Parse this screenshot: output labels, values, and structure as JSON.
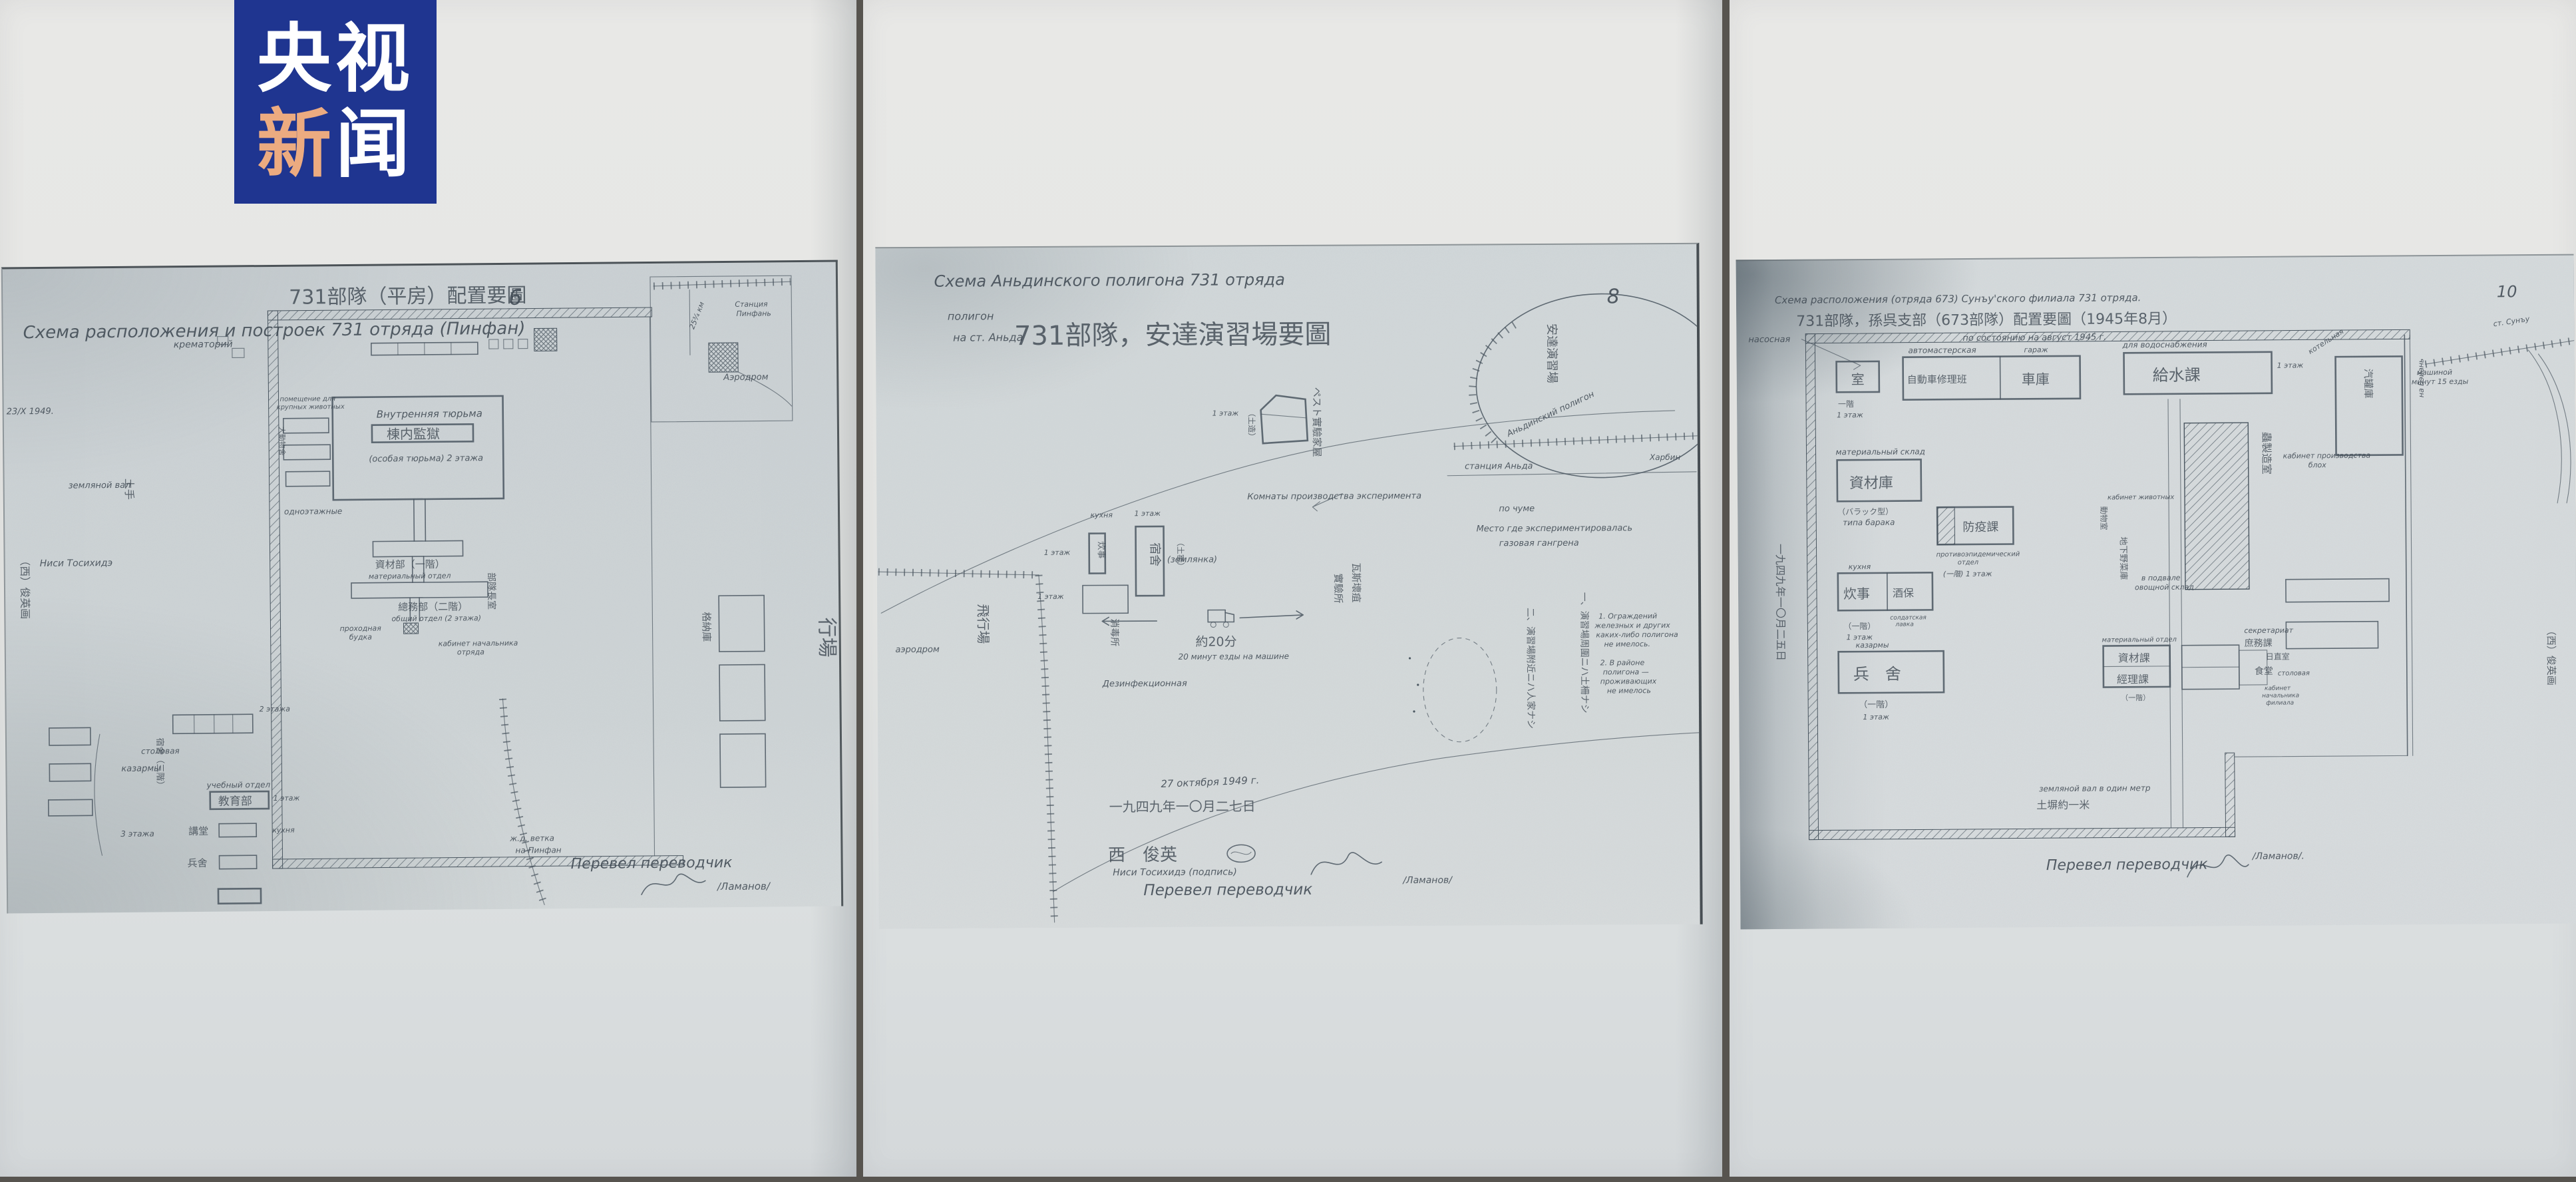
{
  "colors": {
    "logo_bg": "#1f3590",
    "logo_accent": "#ecab80",
    "logo_white": "#ffffff",
    "ink": "#3d4751",
    "paper": "#e6e7e5",
    "copy": "#ccd2d4"
  },
  "logo": {
    "line1": "央视",
    "line2a": "新",
    "line2b": "闻"
  },
  "sheets": [
    {
      "title_cjk": "731部隊（平房）配置要圖",
      "title_ru": "Схема расположения и построек 731 отряда (Пинфан)",
      "page": "6",
      "date_note": "23/X 1949.",
      "west_sig": "（西）俊英画",
      "nisi": "Ниси Тосихидэ",
      "earth_wall_ru": "земляной вал",
      "earth_wall_cjk": "土手",
      "crematorium": "крематорий",
      "station1": "Станция",
      "station2": "Пинфань",
      "km_note": "25¾ км",
      "animals1": "помещение для",
      "animals2": "крупных животных",
      "animals_cjk": "大動物舍",
      "one_story": "одноэтажные",
      "prison_ru": "Внутренняя тюрьма",
      "prison_cjk": "棟内監獄",
      "prison_note": "(особая тюрьма)",
      "prison_floors": "2 этажа",
      "material_cjk": "資材部（一階）",
      "material_ru": "материальный отдел",
      "general_cjk": "總務部（二階）",
      "general_ru": "общий отдел (2 этажа)",
      "gate1": "проходная",
      "gate2": "будка",
      "chief1": "кабинет начальника",
      "chief2": "отряда",
      "chief_cjk": "部隊長室",
      "aero": "Аэродром",
      "hangar_cjk": "格納庫",
      "field_cjk": "行場",
      "dorm_cjk": "宿舍（三階）",
      "barracks": "казармы",
      "dining": "столовая",
      "floors3": "3 этажа",
      "floors2": "2 этажа",
      "edu_ru": "учебный отдел",
      "edu_cjk": "教育部",
      "edu_floor": "1 этаж",
      "kitchen": "кухня",
      "hall_cjk": "講堂",
      "barr2_cjk": "兵舍",
      "rail1": "ж.д. ветка",
      "rail2": "на Пинфан",
      "translator": "Перевел переводчик",
      "lamanov": "/Ламанов/"
    },
    {
      "title_ru": "Схема Аньдинского полигона 731 отряда",
      "sub1": "полигон",
      "sub2": "на ст. Аньда",
      "title_cjk": "731部隊，安達演習場要圖",
      "page": "8",
      "range_cjk": "安達演習場",
      "range_ru": "Аньдинский полигон",
      "station": "станция Аньда",
      "harbin": "Харбин",
      "rooms1": "Комнаты производства эксперимента",
      "rooms2": "по чуме",
      "house_cjk": "ペスト實驗家屋",
      "house_floor": "1 этаж",
      "house_mud": "（土造）",
      "aero": "аэродром",
      "field_cjk": "飛行場",
      "kitchen_ru": "кухня",
      "kitchen_cjk": "炊事",
      "kitchen_floor": "1 этаж",
      "dorm_cjk": "宿舍",
      "dugout_cjk": "（土窑）",
      "dugout_ru": "(землянка)",
      "dorm_floor": "1 этаж",
      "bld_floor": "1 этаж",
      "disinf_cjk": "消毒所",
      "disinf_ru": "Дезинфекционная",
      "drive_cjk": "約20分",
      "drive_ru": "20 минут езды на машине",
      "gas1": "Место где экспериментировалась",
      "gas2": "газовая гангрена",
      "gas_cjk1": "瓦斯壞疽",
      "gas_cjk2": "實驗所",
      "note1_cjk": "一、演習場周圍ニハ土柵ナシ",
      "note2_cjk": "二、演習場附近ニハ人家ナシ",
      "n1a": "1. Ограждений",
      "n1b": "железных и других",
      "n1c": "каких-либо полигона",
      "n1d": "не имелось.",
      "n2a": "2. В районе",
      "n2b": "полигона —",
      "n2c": "проживающих",
      "n2d": "не имелось",
      "date_ru": "27 октября 1949 г.",
      "date_cjk": "一九四九年一〇月二七日",
      "sig_cjk": "西　俊英",
      "sig_ru": "Ниси Тосихидэ (подпись)",
      "translator": "Перевел переводчик",
      "lamanov": "/Ламанов/"
    },
    {
      "title_ru": "Схема расположения (отряда 673) Сунъу'ского филиала 731 отряда.",
      "title_cjk": "731部隊，孫呉支部（673部隊）配置要圖（1945年8月）",
      "asof": "по состоянию на август 1945 г.",
      "page": "10",
      "pump": "насосная",
      "guard_cjk": "室",
      "gfloor_cjk": "一階",
      "gfloor_ru": "1 этаж",
      "auto_ru": "автомастерская",
      "auto_cjk": "自動車修理班",
      "garage_cjk": "車庫",
      "garage_ru": "гараж",
      "water_ru": "для водоснабжения",
      "water_cjk": "給水課",
      "water_floor": "1 этаж",
      "boiler_ru": "котельная",
      "boiler_cjk": "汽罐庫",
      "store_ru": "материальный склад",
      "store_cjk": "資材庫",
      "store_type_cjk": "（バラック型）",
      "store_type_ru": "типа барака",
      "epid_cjk": "防疫課",
      "epid_ru1": "противоэпидемический",
      "epid_ru2": "отдел",
      "epid_floor": "(一階) 1 этаж",
      "flea_cjk": "蟲製造室",
      "flea_ru1": "кабинет производства",
      "flea_ru2": "блох",
      "anim_ru": "кабинет животных",
      "anim_cjk": "動物室",
      "cellar_ru1": "в подвале",
      "cellar_ru2": "овощной склад",
      "cellar_cjk": "地下野菜庫",
      "kitchen_ru": "кухня",
      "kitchen_cjk": "炊事",
      "bar_cjk": "酒保",
      "bar_ru1": "солдатская",
      "bar_ru2": "лавка",
      "kfloor_cjk": "（一階）",
      "kfloor_ru": "1 этаж",
      "barr_ru": "казармы",
      "barr_cjk": "兵　舍",
      "bfloor_cjk": "（一階）",
      "bfloor_ru": "1 этаж",
      "mat2_ru": "материальный отдел",
      "mat2_cjk": "資材課",
      "fin_cjk": "經理課",
      "m2floor": "（一階）",
      "secr_ru": "секретариат",
      "secr_cjk": "庶務課",
      "duty_cjk": "日直室",
      "dine_cjk": "食堂",
      "dine_ru": "столовая",
      "chief1": "кабинет",
      "chief2": "начальника",
      "chief3": "филиала",
      "wall_ru": "земляной вал в один метр",
      "wall_cjk": "土塀約一米",
      "rail_to": "на Бэйань",
      "rail_st": "ст. Сунъу",
      "drive1": "машиной",
      "drive2": "минут 15 езды",
      "date_cjk": "一九四九年一〇月二五日",
      "west_sig": "（西）俊英画",
      "translator": "Перевел переводчик",
      "lamanov": "/Ламанов/."
    }
  ]
}
